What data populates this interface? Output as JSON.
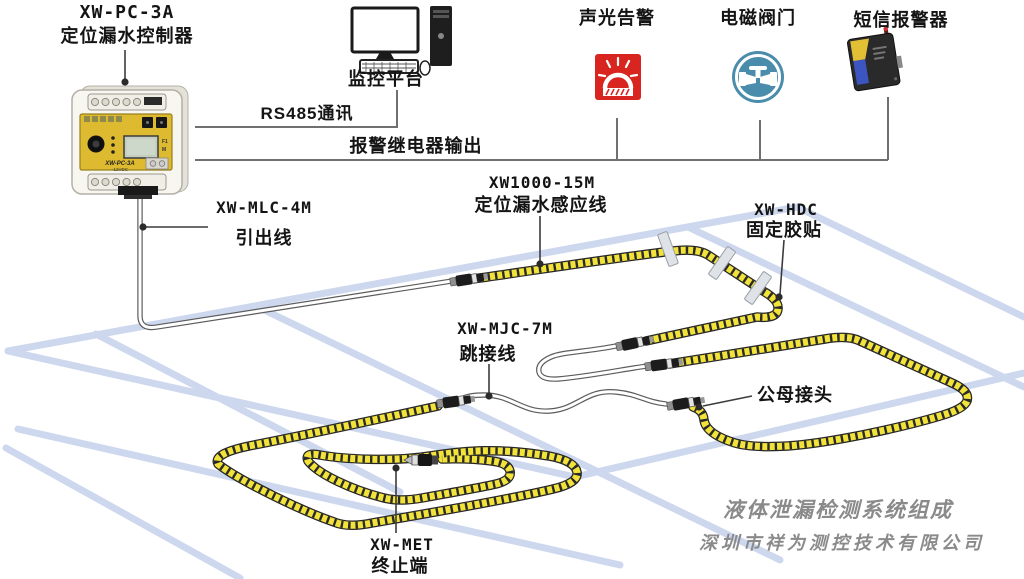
{
  "page": {
    "width": 1024,
    "height": 579,
    "background": "#ffffff"
  },
  "labels": {
    "controller_model": "XW-PC-3A",
    "controller_name": "定位漏水控制器",
    "monitor": "监控平台",
    "rs485": "RS485通讯",
    "relay_output": "报警继电器输出",
    "sound_light": "声光告警",
    "valve": "电磁阀门",
    "sms": "短信报警器",
    "leadout_model": "XW-MLC-4M",
    "leadout_name": "引出线",
    "sensing_model": "XW1000-15M",
    "sensing_name": "定位漏水感应线",
    "tape_model": "XW-HDC",
    "tape_name": "固定胶贴",
    "jumper_model": "XW-MJC-7M",
    "jumper_name": "跳接线",
    "connector": "公母接头",
    "terminator_model": "XW-MET",
    "terminator_name": "终止端",
    "title": "液体泄漏检测系统组成",
    "company": "深圳市祥为测控技术有限公司"
  },
  "panel": {
    "model": "XW-PC-3A",
    "marking": "-12VDC",
    "f1": "F1",
    "m": "M"
  },
  "icons": {
    "monitor": "computer-workstation-icon",
    "sound_light": "siren-beacon-icon",
    "valve": "pipe-valve-icon",
    "sms": "gsm-modem-icon",
    "controller": "din-rail-controller-image",
    "sensing_cable": "yellow-rope-sensing-cable",
    "jumper_cable": "white-jumper-cable",
    "adhesive_tape": "gray-tape-strip",
    "connector": "male-female-connector",
    "terminator": "end-terminator-plug"
  },
  "colors": {
    "sensing_cable_yellow": "#f2e33a",
    "floor_blue": "#cdd8ef",
    "alarm_red": "#d8251f",
    "valve_blue": "#4a8cab",
    "controller_panel_yellow": "#ddba2f",
    "label_text": "#141414",
    "title_gray": "#8a8a8a",
    "line_gray": "#707070"
  }
}
